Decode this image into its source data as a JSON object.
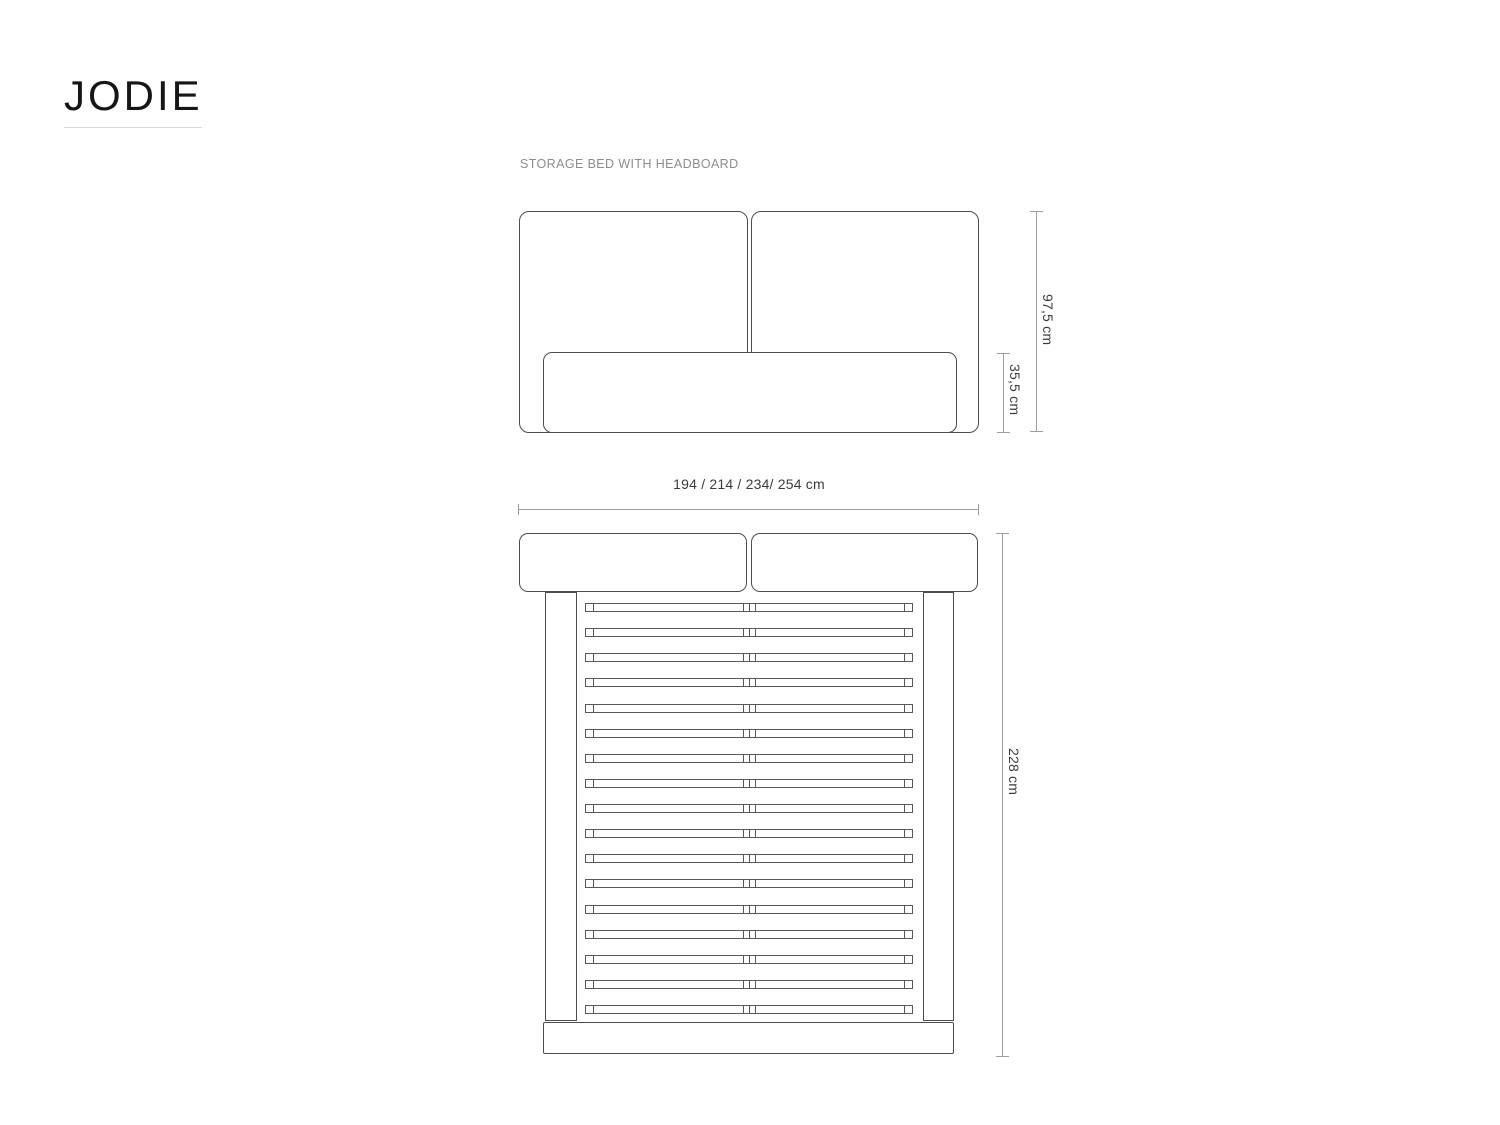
{
  "brand": {
    "name": "JODIE"
  },
  "product_label": "STORAGE BED WITH HEADBOARD",
  "front_view": {
    "headboard_height_label": "97,5 cm",
    "base_height_label": "35,5 cm"
  },
  "width_options_label": "194 / 214 / 234/ 254 cm",
  "top_view": {
    "length_label": "228 cm",
    "slat_count": 17
  },
  "colors": {
    "outline": "#4d4d4d",
    "slat_outline": "#585858",
    "dimension_line": "#9e9e9e",
    "dimension_text": "#3b3b3b",
    "label_muted": "#8d8d8d",
    "logo_text": "#161616",
    "logo_underline": "#d9d9d9",
    "background": "#ffffff"
  }
}
